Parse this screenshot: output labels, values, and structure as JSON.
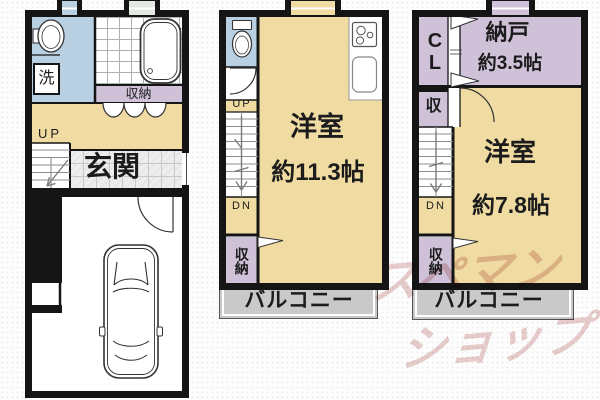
{
  "plan": {
    "floor1": {
      "wash": "洗",
      "storage": "収納",
      "up": "UP",
      "entrance": "玄関"
    },
    "floor2": {
      "up": "UP",
      "dn": "DN",
      "room": "洋室",
      "room_size": "約11.3帖",
      "storage": "収納",
      "balcony": "バルコニー"
    },
    "floor3": {
      "closet": "CL",
      "storeroom": "納戸",
      "storeroom_size": "約3.5帖",
      "storage_small": "収",
      "dn": "DN",
      "room": "洋室",
      "room_size": "約7.8帖",
      "storage": "収納",
      "balcony": "バルコニー"
    },
    "watermark": {
      "line1": "スペマン",
      "line2": "ショップ"
    },
    "colors": {
      "room_tan": "#f0dba2",
      "wet_blue": "#b9cfe2",
      "closet_purple": "#cfc2d8",
      "balcony_gray": "#c9c9c9",
      "wall": "#151515",
      "watermark_pink": "#cc9090"
    }
  }
}
